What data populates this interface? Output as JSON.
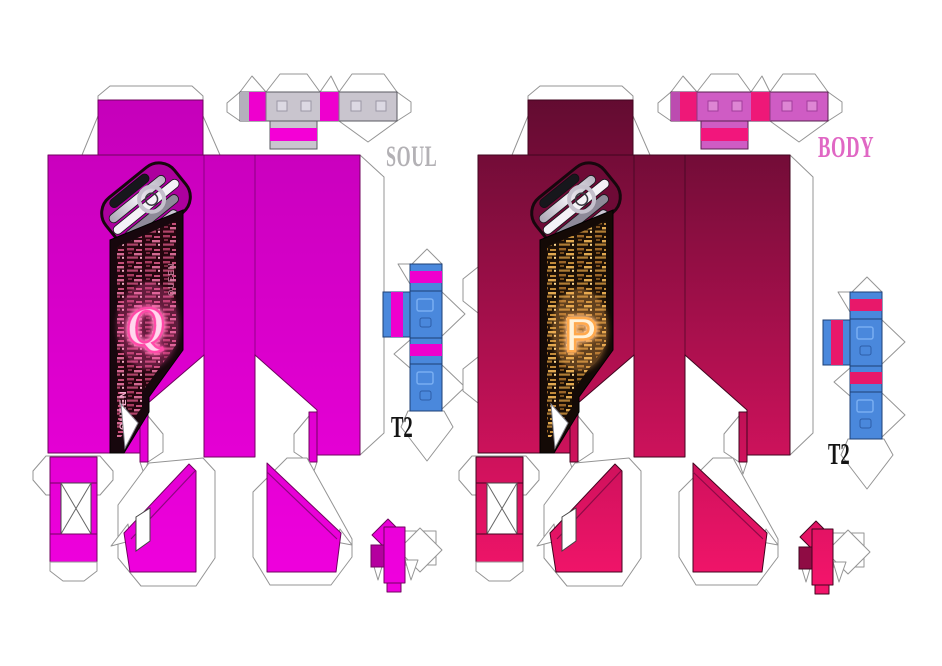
{
  "sheet": {
    "background_color": "#ffffff",
    "description_visible_text_only": true,
    "templates": [
      {
        "name": "soul",
        "label": "SOUL",
        "label_color": "#b3b1b5",
        "size_tag": "T2",
        "size_tag_color": "#141414",
        "screen_letter": "Q",
        "screen_text": "QUEEN",
        "colors": {
          "body_top": "#c400b9",
          "body_bottom": "#ee00dc",
          "accent_stripe": "#ee00ce",
          "strip_base": "#c9c5ce",
          "box_blue": "#4a88dc",
          "screen_bg": "#26060f",
          "screen_glow": "#ff49a8"
        }
      },
      {
        "name": "body",
        "label": "BODY",
        "label_color": "#e067c4",
        "size_tag": "T2",
        "size_tag_color": "#141414",
        "screen_letter": "P",
        "screen_text": "",
        "colors": {
          "body_top": "#5e0b2f",
          "body_bottom": "#f2146a",
          "accent_stripe": "#ee1878",
          "strip_base": "#cf5cc4",
          "box_blue": "#4a88dc",
          "screen_bg": "#1d1006",
          "screen_glow": "#ffa94e"
        }
      }
    ]
  }
}
